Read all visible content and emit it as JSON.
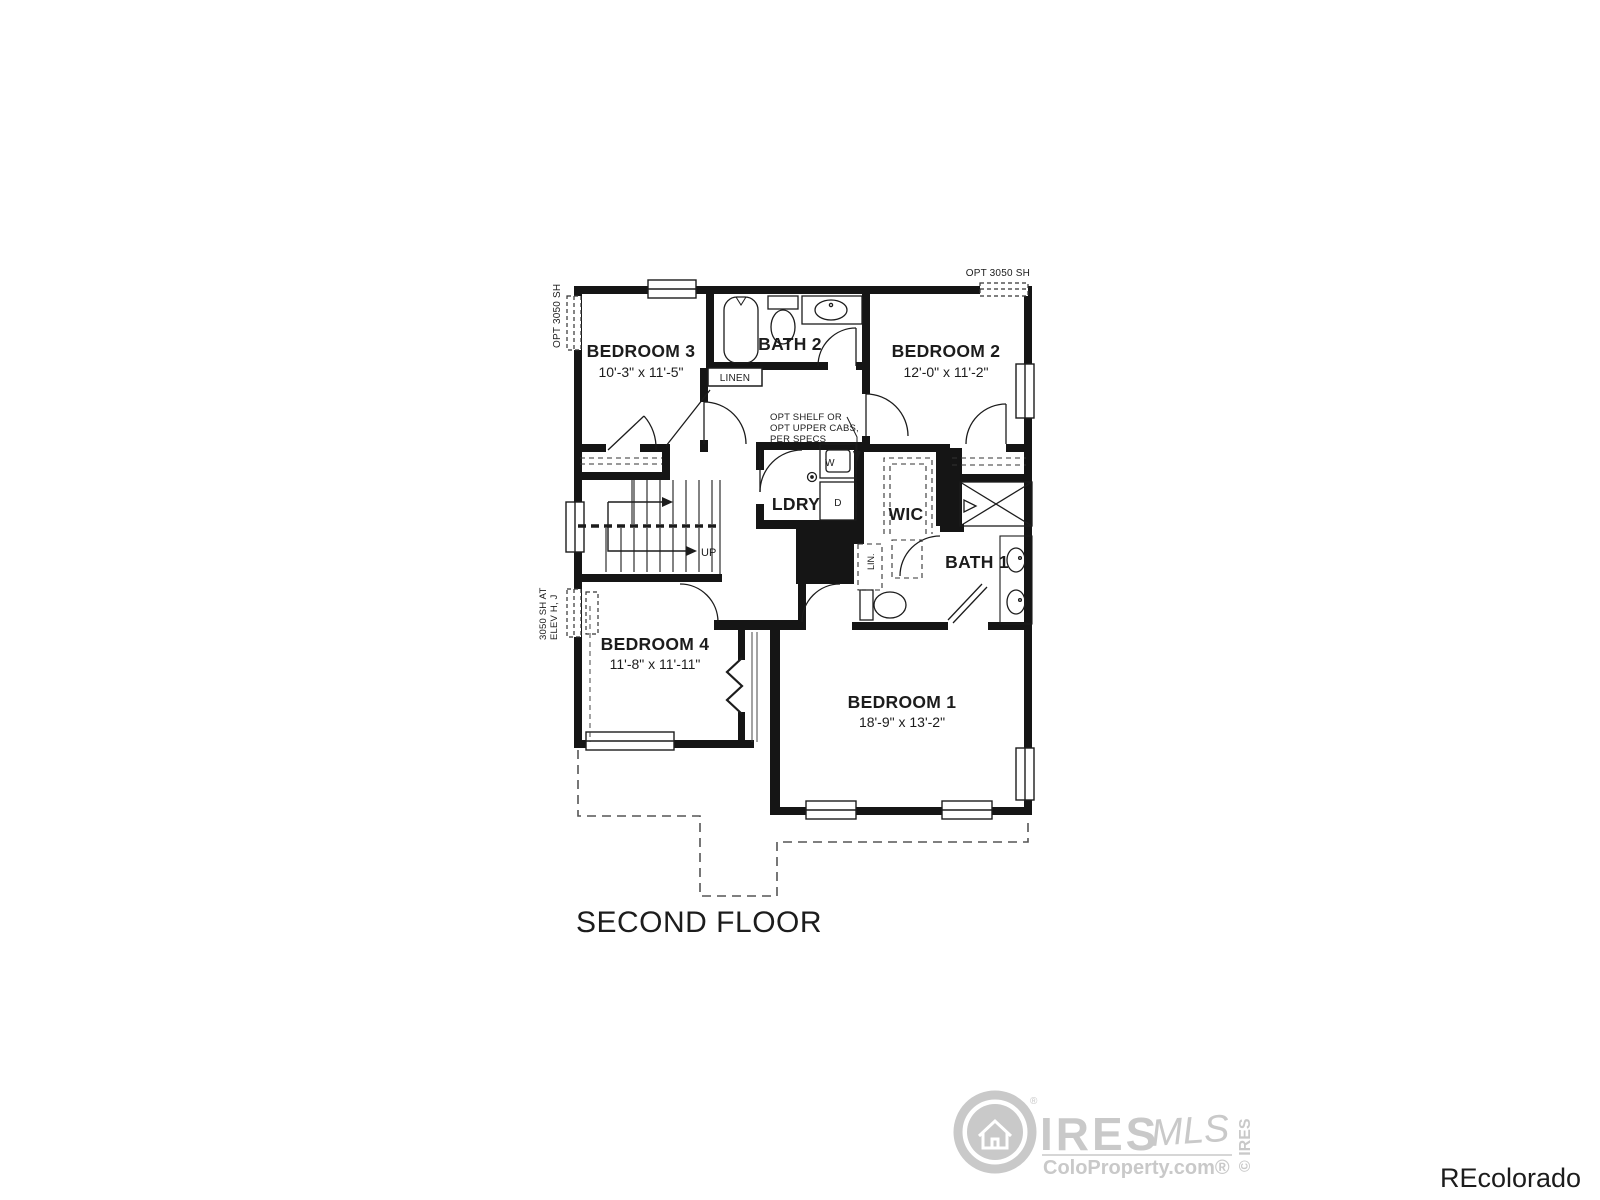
{
  "plan": {
    "floor_title": "SECOND FLOOR",
    "rooms": {
      "bedroom3": {
        "name": "BEDROOM 3",
        "dims": "10'-3\" x 11'-5\""
      },
      "bath2": {
        "name": "BATH 2"
      },
      "bedroom2": {
        "name": "BEDROOM 2",
        "dims": "12'-0\" x 11'-2\""
      },
      "bedroom4": {
        "name": "BEDROOM 4",
        "dims": "11'-8\" x 11'-11\""
      },
      "bedroom1": {
        "name": "BEDROOM 1",
        "dims": "18'-9\" x 13'-2\""
      },
      "ldry": {
        "name": "LDRY"
      },
      "wic": {
        "name": "WIC"
      },
      "bath1": {
        "name": "BATH 1"
      },
      "linen": {
        "name": "LINEN"
      },
      "lin": {
        "name": "LIN."
      }
    },
    "appliances": {
      "washer": "W",
      "dryer": "D"
    },
    "stairs": {
      "direction": "UP"
    },
    "annotations": {
      "opt_shelf": [
        "OPT SHELF OR",
        "OPT UPPER CABS,",
        "PER SPECS"
      ],
      "opt_window_top_right": "OPT 3050 SH",
      "opt_window_left": "OPT 3050 SH",
      "elev_window": [
        "3050 SH AT",
        "ELEV H, J"
      ]
    },
    "ink_color": "#1c1c1c"
  },
  "watermarks": {
    "ires_logo": {
      "brand": "IRES",
      "suffix": "MLS",
      "site": "ColoProperty.com®",
      "registered": "®",
      "vertical": "© IRES",
      "color": "#c9c9c9"
    },
    "recolorado": {
      "text": "REcolorado",
      "color": "#9e9e9e"
    }
  }
}
